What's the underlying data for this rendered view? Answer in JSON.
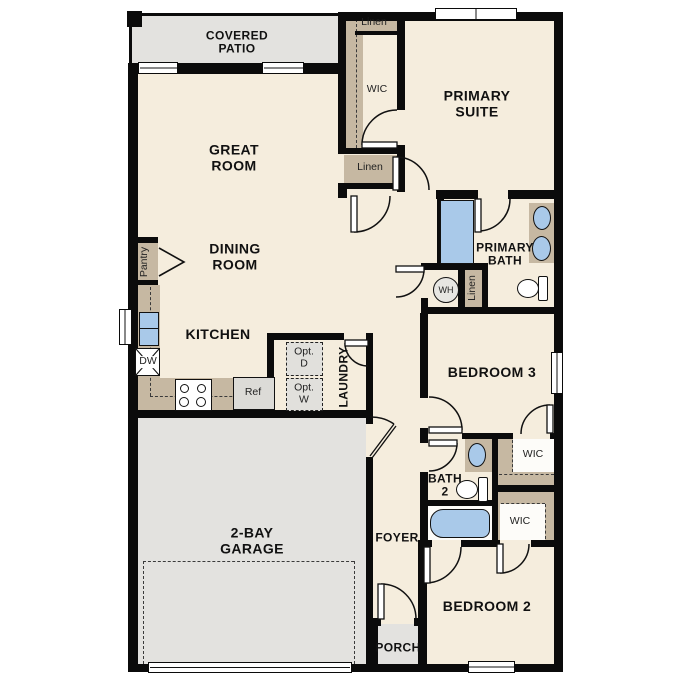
{
  "rooms": {
    "covered_patio": {
      "l1": "COVERED",
      "l2": "PATIO"
    },
    "great_room": {
      "l1": "GREAT",
      "l2": "ROOM"
    },
    "dining_room": {
      "l1": "DINING",
      "l2": "ROOM"
    },
    "kitchen": {
      "label": "KITCHEN"
    },
    "primary_suite": {
      "l1": "PRIMARY",
      "l2": "SUITE"
    },
    "primary_bath": {
      "l1": "PRIMARY",
      "l2": "BATH"
    },
    "bedroom3": {
      "label": "BEDROOM 3"
    },
    "bedroom2": {
      "label": "BEDROOM 2"
    },
    "bath2": {
      "l1": "BATH",
      "l2": "2"
    },
    "garage": {
      "l1": "2-BAY",
      "l2": "GARAGE"
    },
    "foyer": {
      "label": "FOYER"
    },
    "porch": {
      "label": "PORCH"
    },
    "laundry": {
      "label": "LAUNDRY"
    }
  },
  "closets": {
    "wic_primary": "WIC",
    "wic_bedroom3": "WIC",
    "wic_bedroom2": "WIC",
    "linen_top": "Linen",
    "linen_hall": "Linen",
    "linen_bath": "Linen",
    "pantry": "Pantry"
  },
  "fixtures": {
    "dishwasher": "DW",
    "refrigerator": "Ref",
    "water_heater": "WH",
    "optional_dryer": {
      "l1": "Opt.",
      "l2": "D"
    },
    "optional_washer": {
      "l1": "Opt.",
      "l2": "W"
    }
  },
  "colors": {
    "wall": "#0b0b0b",
    "floor": "#f5eddd",
    "outdoor_gray": "#e3e2df",
    "closet_tan": "#c6b8a2",
    "fixture_blue": "#a9c9e9",
    "appliance_gray": "#dcdbd7"
  }
}
